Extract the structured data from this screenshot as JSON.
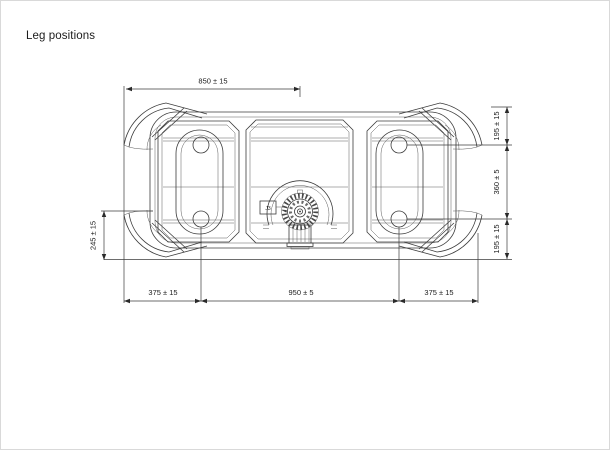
{
  "page": {
    "title": "Leg positions",
    "background": "#ffffff"
  },
  "drawing": {
    "part_label": "J3",
    "dimensions": {
      "top_width": "850 ± 15",
      "bottom_left": "375 ± 15",
      "bottom_center": "950 ± 5",
      "bottom_right": "375 ± 15",
      "right_top": "195 ± 15",
      "right_middle": "360 ± 5",
      "right_bottom": "195 ± 15",
      "left_height": "245 ± 15"
    },
    "colors": {
      "line": "#3c3c3c",
      "text": "#1c1c1c"
    }
  }
}
